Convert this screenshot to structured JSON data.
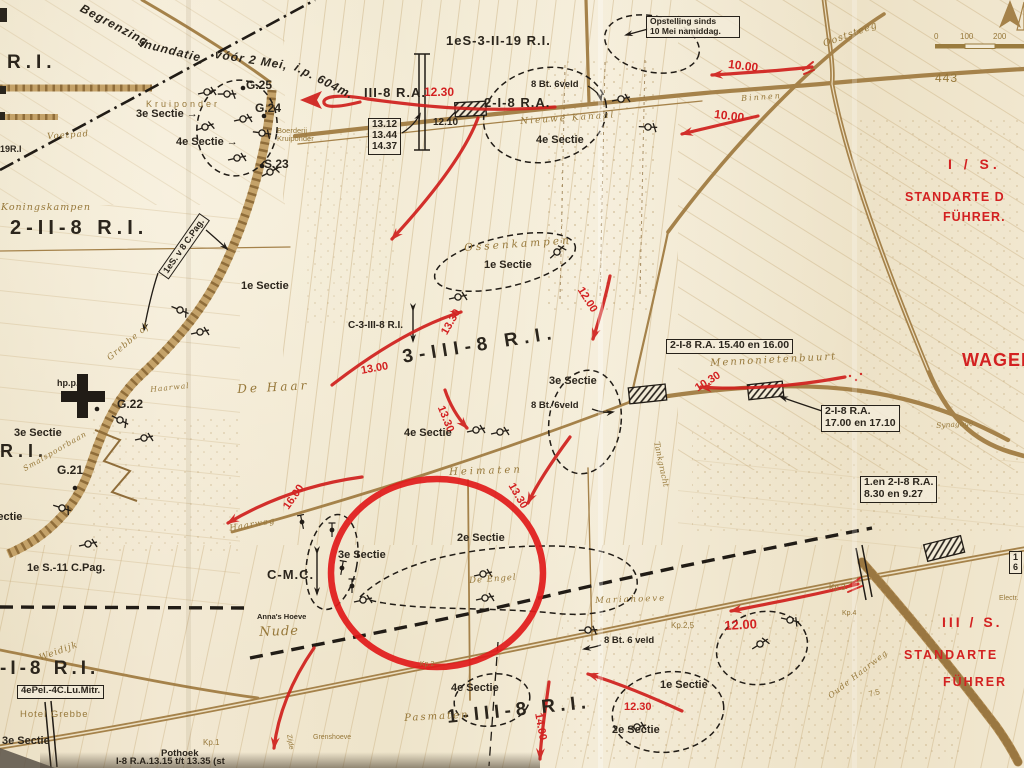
{
  "map": {
    "colors": {
      "paper": "#f0e6cf",
      "line_brown": "#a5824a",
      "text_brown": "#97783a",
      "ink": "#2b251c",
      "red": "#d32121"
    },
    "labels": [
      {
        "name": "inundation-note-1",
        "text": "Begrenzing",
        "x": 84,
        "y": 2,
        "fs": 12,
        "rot": 28,
        "ls": 1,
        "cls": "i b"
      },
      {
        "name": "inundation-note-2",
        "text": "inundatie,",
        "x": 142,
        "y": 37,
        "fs": 12,
        "rot": 14,
        "ls": 1,
        "cls": "i b"
      },
      {
        "name": "inundation-note-3",
        "text": "vóór 2 Mei,",
        "x": 216,
        "y": 48,
        "fs": 12,
        "rot": 9,
        "ls": 1,
        "cls": "i b"
      },
      {
        "name": "inundation-note-4",
        "text": "i.p. 604m.",
        "x": 298,
        "y": 61,
        "fs": 12,
        "rot": 27,
        "ls": 1,
        "cls": "i b"
      },
      {
        "name": "unit-ri-topleft",
        "text": "R.I.",
        "x": 7,
        "y": 52,
        "fs": 19,
        "ls": 5,
        "cls": "b"
      },
      {
        "name": "unit-19ri",
        "text": "19R.I",
        "x": 0,
        "y": 144,
        "fs": 9,
        "cls": "b"
      },
      {
        "name": "point-g25",
        "text": "G.25",
        "x": 246,
        "y": 79,
        "fs": 12,
        "cls": "b"
      },
      {
        "name": "point-g24",
        "text": "G.24",
        "x": 255,
        "y": 102,
        "fs": 12,
        "cls": "b"
      },
      {
        "name": "point-s23",
        "text": "S.23",
        "x": 264,
        "y": 158,
        "fs": 12,
        "cls": "b"
      },
      {
        "name": "sectie-3-topleft",
        "text": "3e Sectie →",
        "x": 136,
        "y": 108,
        "fs": 11,
        "cls": "b"
      },
      {
        "name": "sectie-4-topleft",
        "text": "4e Sectie →",
        "x": 176,
        "y": 136,
        "fs": 11,
        "cls": "b"
      },
      {
        "name": "place-kruiponder",
        "text": "Kruiponder",
        "x": 146,
        "y": 99,
        "fs": 9,
        "ls": 3,
        "cls": "brs"
      },
      {
        "name": "place-boerderij-kruiponder",
        "text": "Boerderij\nKruiponder",
        "x": 277,
        "y": 127,
        "fs": 7.5,
        "cls": "brs"
      },
      {
        "name": "place-voetpad",
        "text": "Voetpad",
        "x": 47,
        "y": 133,
        "fs": 8.5,
        "rot": -4,
        "ls": 1,
        "cls": "br"
      },
      {
        "name": "unit-1es-3-ii-19ri",
        "text": "1eS-3-II-19 R.I.",
        "x": 446,
        "y": 34,
        "fs": 13,
        "ls": 1,
        "cls": "b"
      },
      {
        "name": "unit-iii-8ra",
        "text": "III-8 R.A.",
        "x": 364,
        "y": 86,
        "fs": 13,
        "ls": 1,
        "cls": "b"
      },
      {
        "name": "time-1230-top",
        "text": "12.30",
        "x": 424,
        "y": 86,
        "fs": 12,
        "cls": "rd"
      },
      {
        "name": "unit-2-i-8ra-top",
        "text": "2-I-8 R.A.",
        "x": 484,
        "y": 96,
        "fs": 13,
        "ls": 1,
        "cls": "b"
      },
      {
        "name": "time-1210",
        "text": "12.10",
        "x": 433,
        "y": 117,
        "fs": 10,
        "cls": "b"
      },
      {
        "name": "times-railway",
        "text": "13.12\n13.44\n14.37",
        "x": 368,
        "y": 118,
        "fs": 10,
        "cls": "bx"
      },
      {
        "name": "unit-8bt6veld-top",
        "text": "8 Bt. 6veld",
        "x": 531,
        "y": 80,
        "fs": 9.5,
        "cls": "b"
      },
      {
        "name": "place-nieuwe-kanaal",
        "text": "Nieuwe Kanaal",
        "x": 520,
        "y": 117,
        "fs": 9,
        "rot": -4,
        "ls": 2,
        "cls": "br"
      },
      {
        "name": "sectie-4-top",
        "text": "4e Sectie",
        "x": 536,
        "y": 134,
        "fs": 11,
        "cls": "b"
      },
      {
        "name": "note-opstelling",
        "text": "Opstelling sinds\n10 Mei namiddag.",
        "x": 646,
        "y": 16,
        "fs": 8.5,
        "w": 86,
        "cls": "bx"
      },
      {
        "name": "place-ooststeeg",
        "text": "Ooststeeg",
        "x": 822,
        "y": 40,
        "fs": 9.5,
        "rot": -20,
        "ls": 1,
        "cls": "br"
      },
      {
        "name": "time-1000-a",
        "text": "10.00",
        "x": 729,
        "y": 58,
        "fs": 12,
        "rot": 7,
        "cls": "rd"
      },
      {
        "name": "time-1000-b",
        "text": "10.00",
        "x": 715,
        "y": 108,
        "fs": 12,
        "rot": 7,
        "cls": "rd"
      },
      {
        "name": "place-binnen",
        "text": "Binnen",
        "x": 741,
        "y": 95,
        "fs": 8,
        "rot": -4,
        "ls": 2,
        "cls": "br"
      },
      {
        "name": "elevation-443",
        "text": "443",
        "x": 935,
        "y": 72,
        "fs": 12,
        "ls": 1,
        "cls": "brs"
      },
      {
        "name": "scale-tick-0",
        "text": "0",
        "x": 934,
        "y": 33,
        "fs": 8,
        "cls": "brs"
      },
      {
        "name": "scale-tick-100",
        "text": "100",
        "x": 960,
        "y": 33,
        "fs": 8,
        "cls": "brs"
      },
      {
        "name": "scale-tick-200",
        "text": "200",
        "x": 993,
        "y": 33,
        "fs": 8,
        "cls": "brs"
      },
      {
        "name": "unit-i-s-red",
        "text": "I / S.",
        "x": 948,
        "y": 157,
        "fs": 14,
        "ls": 4,
        "cls": "rd"
      },
      {
        "name": "unit-standarte-1",
        "text": "STANDARTE D",
        "x": 905,
        "y": 190,
        "fs": 12.5,
        "ls": 1,
        "cls": "rd"
      },
      {
        "name": "unit-fuhrer-1",
        "text": "FÜHRER.",
        "x": 943,
        "y": 210,
        "fs": 12.5,
        "ls": 1,
        "cls": "rd"
      },
      {
        "name": "place-wageningen",
        "text": "WAGEN",
        "x": 962,
        "y": 350,
        "fs": 18,
        "ls": 1,
        "cls": "rd"
      },
      {
        "name": "place-koningskampen",
        "text": "Koningskampen",
        "x": 1,
        "y": 203,
        "fs": 9.5,
        "ls": 1,
        "cls": "br"
      },
      {
        "name": "unit-2-ii-8ri",
        "text": "2-II-8 R.I.",
        "x": 10,
        "y": 217,
        "fs": 20,
        "ls": 5,
        "cls": "b"
      },
      {
        "name": "unit-1es-v8-cpag",
        "text": "1eS. v 8 C.Pag.",
        "x": 158,
        "y": 272,
        "fs": 9,
        "rot": -55,
        "cls": "bx"
      },
      {
        "name": "sectie-1-dehaar",
        "text": "1e Sectie",
        "x": 241,
        "y": 280,
        "fs": 11,
        "cls": "b"
      },
      {
        "name": "place-grebbe",
        "text": "Grebbe of",
        "x": 106,
        "y": 356,
        "fs": 8.5,
        "rot": -40,
        "ls": 1,
        "cls": "br"
      },
      {
        "name": "point-hpp",
        "text": "hp.p.",
        "x": 57,
        "y": 378,
        "fs": 9,
        "cls": "b"
      },
      {
        "name": "point-g22",
        "text": "G.22",
        "x": 117,
        "y": 398,
        "fs": 12,
        "cls": "b"
      },
      {
        "name": "place-de-haar",
        "text": "De Haar",
        "x": 237,
        "y": 383,
        "fs": 12,
        "rot": -3,
        "ls": 3,
        "cls": "br"
      },
      {
        "name": "place-haarwal",
        "text": "Haarwal",
        "x": 150,
        "y": 386,
        "fs": 7.5,
        "rot": -6,
        "ls": 1,
        "cls": "br"
      },
      {
        "name": "sectie-3-left",
        "text": "3e Sectie",
        "x": 14,
        "y": 427,
        "fs": 11,
        "cls": "b"
      },
      {
        "name": "unit-ri-left",
        "text": "R.I.",
        "x": 0,
        "y": 441,
        "fs": 18,
        "ls": 5,
        "cls": "b"
      },
      {
        "name": "point-g21",
        "text": "G.21",
        "x": 57,
        "y": 464,
        "fs": 12,
        "cls": "b"
      },
      {
        "name": "place-smalspoorbaan",
        "text": "Smalspoorbaan",
        "x": 22,
        "y": 466,
        "fs": 7.5,
        "rot": -30,
        "ls": 1,
        "cls": "br"
      },
      {
        "name": "sectie-left-edge",
        "text": "Sectie",
        "x": -10,
        "y": 511,
        "fs": 11,
        "cls": "b"
      },
      {
        "name": "unit-1es-11-cpag",
        "text": "1e S.-11 C.Pag.",
        "x": 27,
        "y": 562,
        "fs": 11,
        "cls": "b"
      },
      {
        "name": "place-heimaten",
        "text": "Heimaten",
        "x": 449,
        "y": 467,
        "fs": 10,
        "rot": -2,
        "ls": 3,
        "cls": "br"
      },
      {
        "name": "time-1600",
        "text": "16.00",
        "x": 281,
        "y": 505,
        "fs": 11,
        "rot": -55,
        "cls": "rd"
      },
      {
        "name": "place-haarweg-west",
        "text": "Haarweg",
        "x": 229,
        "y": 525,
        "fs": 8.5,
        "rot": -10,
        "ls": 1,
        "cls": "br"
      },
      {
        "name": "sectie-3-circle",
        "text": "3e Sectie",
        "x": 338,
        "y": 549,
        "fs": 11,
        "cls": "b"
      },
      {
        "name": "sectie-2-circle",
        "text": "2e Sectie",
        "x": 457,
        "y": 532,
        "fs": 11,
        "cls": "b"
      },
      {
        "name": "unit-c-mc",
        "text": "C-M.C.",
        "x": 267,
        "y": 568,
        "fs": 13,
        "ls": 1,
        "cls": "b"
      },
      {
        "name": "place-de-engel",
        "text": "De Engel",
        "x": 469,
        "y": 577,
        "fs": 8.5,
        "rot": -4,
        "ls": 1,
        "cls": "br"
      },
      {
        "name": "place-annas-hoeve",
        "text": "Anna's Hoeve",
        "x": 257,
        "y": 613,
        "fs": 7.5,
        "cls": "b"
      },
      {
        "name": "place-nude",
        "text": "Nude",
        "x": 259,
        "y": 626,
        "fs": 13,
        "rot": -2,
        "ls": 1,
        "cls": "br"
      },
      {
        "name": "time-1330-c",
        "text": "13.30",
        "x": 516,
        "y": 481,
        "fs": 11,
        "rot": 60,
        "cls": "rd"
      },
      {
        "name": "place-mennonietenbuurt",
        "text": "Mennonietenbuurt",
        "x": 710,
        "y": 358,
        "fs": 10,
        "rot": -3,
        "ls": 2,
        "cls": "br"
      },
      {
        "name": "time-1030",
        "text": "10.30",
        "x": 693,
        "y": 384,
        "fs": 11,
        "rot": -32,
        "cls": "rd"
      },
      {
        "name": "unit-2i8ra-1540",
        "text": "2-I-8 R.A. 15.40 en 16.00",
        "x": 666,
        "y": 339,
        "fs": 10.5,
        "cls": "bx"
      },
      {
        "name": "unit-2i8ra-1700",
        "text": "2-I-8 R.A.\n17.00 en 17.10",
        "x": 821,
        "y": 405,
        "fs": 10.5,
        "cls": "bx"
      },
      {
        "name": "place-synagoge",
        "text": "Synagoge",
        "x": 936,
        "y": 422,
        "fs": 7.5,
        "rot": -4,
        "cls": "br"
      },
      {
        "name": "unit-1en2i8ra-830",
        "text": "1.en 2-I-8 R.A.\n8.30 en 9.27",
        "x": 860,
        "y": 476,
        "fs": 10.5,
        "cls": "bx"
      },
      {
        "name": "place-tankgracht",
        "text": "Tankgracht",
        "x": 660,
        "y": 441,
        "fs": 8,
        "rot": 78,
        "cls": "br"
      },
      {
        "name": "unit-c-3-iii-8ri",
        "text": "C-3-III-8 R.I.",
        "x": 348,
        "y": 320,
        "fs": 10,
        "cls": "b"
      },
      {
        "name": "time-1300",
        "text": "13.00",
        "x": 360,
        "y": 365,
        "fs": 11,
        "rot": -10,
        "cls": "rd"
      },
      {
        "name": "time-1330-a",
        "text": "13.30",
        "x": 439,
        "y": 331,
        "fs": 11,
        "rot": -60,
        "cls": "rd"
      },
      {
        "name": "unit-3-iii-8ri",
        "text": "3-III-8 R.I.",
        "x": 401,
        "y": 347,
        "fs": 19,
        "rot": -9,
        "ls": 6,
        "cls": "b"
      },
      {
        "name": "time-1330-b",
        "text": "13.30",
        "x": 446,
        "y": 404,
        "fs": 11,
        "rot": 68,
        "cls": "rd"
      },
      {
        "name": "time-1200-a",
        "text": "12.00",
        "x": 585,
        "y": 285,
        "fs": 11,
        "rot": 58,
        "cls": "rd"
      },
      {
        "name": "sectie-3-mid",
        "text": "3e Sectie",
        "x": 549,
        "y": 375,
        "fs": 11,
        "cls": "b"
      },
      {
        "name": "unit-8bt6veld-mid",
        "text": "8 Bt. 6veld",
        "x": 531,
        "y": 401,
        "fs": 9.5,
        "cls": "b"
      },
      {
        "name": "sectie-4-mid",
        "text": "4e Sectie",
        "x": 404,
        "y": 427,
        "fs": 11,
        "cls": "b"
      },
      {
        "name": "place-ossenkampen",
        "text": "Ossenkampen",
        "x": 464,
        "y": 243,
        "fs": 10.5,
        "rot": -4,
        "ls": 3,
        "cls": "br"
      },
      {
        "name": "sectie-1-ossenkampen",
        "text": "1e Sectie",
        "x": 484,
        "y": 259,
        "fs": 11,
        "cls": "b"
      },
      {
        "name": "place-mariahoeve",
        "text": "Mariahoeve",
        "x": 595,
        "y": 597,
        "fs": 8.5,
        "rot": -2,
        "ls": 2,
        "cls": "br"
      },
      {
        "name": "place-kp3",
        "text": "Kp.3",
        "x": 829,
        "y": 584,
        "fs": 8,
        "cls": "brs"
      },
      {
        "name": "place-kp25",
        "text": "Kp.2,5",
        "x": 671,
        "y": 622,
        "fs": 8,
        "cls": "brs"
      },
      {
        "name": "place-kp4",
        "text": "Kp.4",
        "x": 842,
        "y": 610,
        "fs": 7,
        "cls": "brs"
      },
      {
        "name": "time-1200-b",
        "text": "12.00",
        "x": 724,
        "y": 619,
        "fs": 13,
        "rot": -3,
        "cls": "rd"
      },
      {
        "name": "unit-8bt6veld-bottom",
        "text": "8 Bt. 6 veld",
        "x": 604,
        "y": 636,
        "fs": 9.5,
        "cls": "b"
      },
      {
        "name": "place-oude-haarweg",
        "text": "Oude Haarweg",
        "x": 827,
        "y": 694,
        "fs": 8,
        "rot": -38,
        "ls": 1,
        "cls": "br"
      },
      {
        "name": "sectie-1-bottom",
        "text": "1e Sectie",
        "x": 660,
        "y": 679,
        "fs": 11,
        "cls": "b"
      },
      {
        "name": "time-1230-b",
        "text": "12.30",
        "x": 624,
        "y": 701,
        "fs": 11,
        "cls": "rd"
      },
      {
        "name": "sectie-2-bottom",
        "text": "2e Sectie",
        "x": 612,
        "y": 724,
        "fs": 11,
        "cls": "b"
      },
      {
        "name": "unit-1-iii-8ri",
        "text": "1-III-8 R.I.",
        "x": 446,
        "y": 707,
        "fs": 19,
        "rot": -6,
        "ls": 5,
        "cls": "b"
      },
      {
        "name": "sectie-4-bottom",
        "text": "4e Sectie",
        "x": 451,
        "y": 682,
        "fs": 11,
        "cls": "b"
      },
      {
        "name": "place-pasmaten",
        "text": "Pasmaten",
        "x": 404,
        "y": 713,
        "fs": 10,
        "rot": -3,
        "ls": 2,
        "cls": "br"
      },
      {
        "name": "time-1400",
        "text": "14.00",
        "x": 544,
        "y": 712,
        "fs": 11,
        "rot": 80,
        "cls": "rd"
      },
      {
        "name": "place-grenshoeve",
        "text": "Grenshoeve",
        "x": 313,
        "y": 734,
        "fs": 7,
        "cls": "brs"
      },
      {
        "name": "place-kp2",
        "text": "Kp.2",
        "x": 420,
        "y": 661,
        "fs": 7,
        "cls": "brs"
      },
      {
        "name": "place-kp1",
        "text": "Kp.1",
        "x": 203,
        "y": 739,
        "fs": 8,
        "cls": "brs"
      },
      {
        "name": "place-pothoek",
        "text": "Pothoek",
        "x": 161,
        "y": 749,
        "fs": 9.5,
        "cls": "b"
      },
      {
        "name": "unit-i8ra-bottom",
        "text": "I-8 R.A.13.15 t/t 13.35 (st",
        "x": 116,
        "y": 757,
        "fs": 9.5,
        "cls": "b"
      },
      {
        "name": "place-weidijk",
        "text": "Weidijk",
        "x": 38,
        "y": 654,
        "fs": 9,
        "rot": -20,
        "ls": 1,
        "cls": "br"
      },
      {
        "name": "place-hotel-grebbe",
        "text": "Hotel Grebbe",
        "x": 20,
        "y": 710,
        "fs": 9.5,
        "ls": 1,
        "cls": "brs"
      },
      {
        "name": "unit-i-8ri-bottom",
        "text": "-I-8 R.I.",
        "x": 0,
        "y": 658,
        "fs": 19,
        "ls": 4,
        "cls": "b"
      },
      {
        "name": "unit-4epel-4clumitr",
        "text": "4ePel.-4C.Lu.Mitr.",
        "x": 17,
        "y": 685,
        "fs": 9.5,
        "cls": "bx"
      },
      {
        "name": "sectie-3-bottomleft",
        "text": "3e Sectie",
        "x": 2,
        "y": 735,
        "fs": 11,
        "cls": "b"
      },
      {
        "name": "unit-iii-s-red",
        "text": "III / S.",
        "x": 942,
        "y": 615,
        "fs": 14,
        "ls": 3,
        "cls": "rd"
      },
      {
        "name": "unit-standarte-2",
        "text": "STANDARTE",
        "x": 904,
        "y": 648,
        "fs": 12.5,
        "ls": 2,
        "cls": "rd"
      },
      {
        "name": "unit-fuhrer-2",
        "text": "FÜHRER",
        "x": 943,
        "y": 675,
        "fs": 12.5,
        "ls": 2,
        "cls": "rd"
      },
      {
        "name": "place-electr",
        "text": "Electr.",
        "x": 999,
        "y": 595,
        "fs": 7,
        "cls": "brs"
      },
      {
        "name": "elevation-75",
        "text": "7.5",
        "x": 868,
        "y": 691,
        "fs": 8,
        "rot": -15,
        "cls": "brs"
      },
      {
        "name": "place-zijde",
        "text": "Zijde",
        "x": 292,
        "y": 734,
        "fs": 7,
        "rot": 80,
        "cls": "brs"
      },
      {
        "name": "note-box-edge",
        "text": "1\n6",
        "x": 1009,
        "y": 551,
        "fs": 9,
        "cls": "bx"
      }
    ]
  }
}
